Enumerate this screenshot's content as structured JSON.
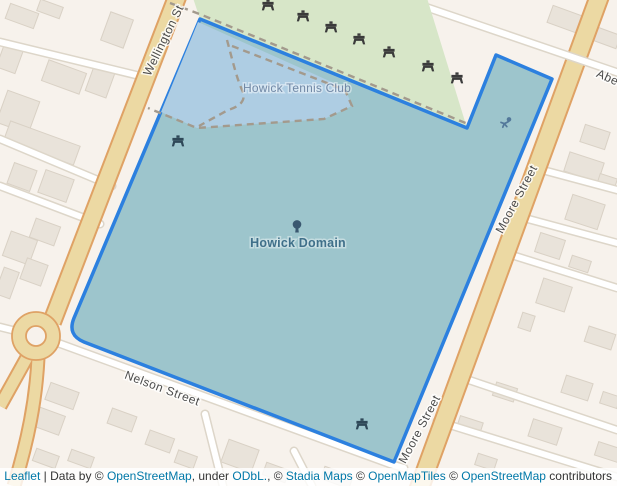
{
  "map": {
    "poi_labels": {
      "tennis_club": "Howick Tennis Club",
      "domain": "Howick Domain"
    },
    "street_labels": {
      "wellington": "Wellington St",
      "moore": "Moore Street",
      "nelson": "Nelson Street",
      "aberfeldy_partial": "Abe"
    },
    "icons": [
      "picnic-table-icon",
      "tree-icon",
      "fitness-station-icon"
    ],
    "colors": {
      "background": "#f7f2ec",
      "selection_outline": "#2c80df",
      "selection_fill": "#9dc5cc",
      "tennis_overlap_fill": "#aecde3",
      "park_green": "#d7e6c8",
      "road_primary_fill": "#ecd9a3",
      "road_primary_casing": "#dfa265",
      "poi_label": "#40708a",
      "attribution_link": "#0078a8"
    }
  },
  "attribution": {
    "parts": [
      {
        "text": "Leaflet"
      },
      {
        "text": " | Data by © "
      },
      {
        "text": "OpenStreetMap"
      },
      {
        "text": ", under "
      },
      {
        "text": "ODbL."
      },
      {
        "text": ", © "
      },
      {
        "text": "Stadia Maps"
      },
      {
        "text": " © "
      },
      {
        "text": "OpenMapTiles"
      },
      {
        "text": " © "
      },
      {
        "text": "OpenStreetMap"
      },
      {
        "text": " contributors"
      }
    ]
  }
}
